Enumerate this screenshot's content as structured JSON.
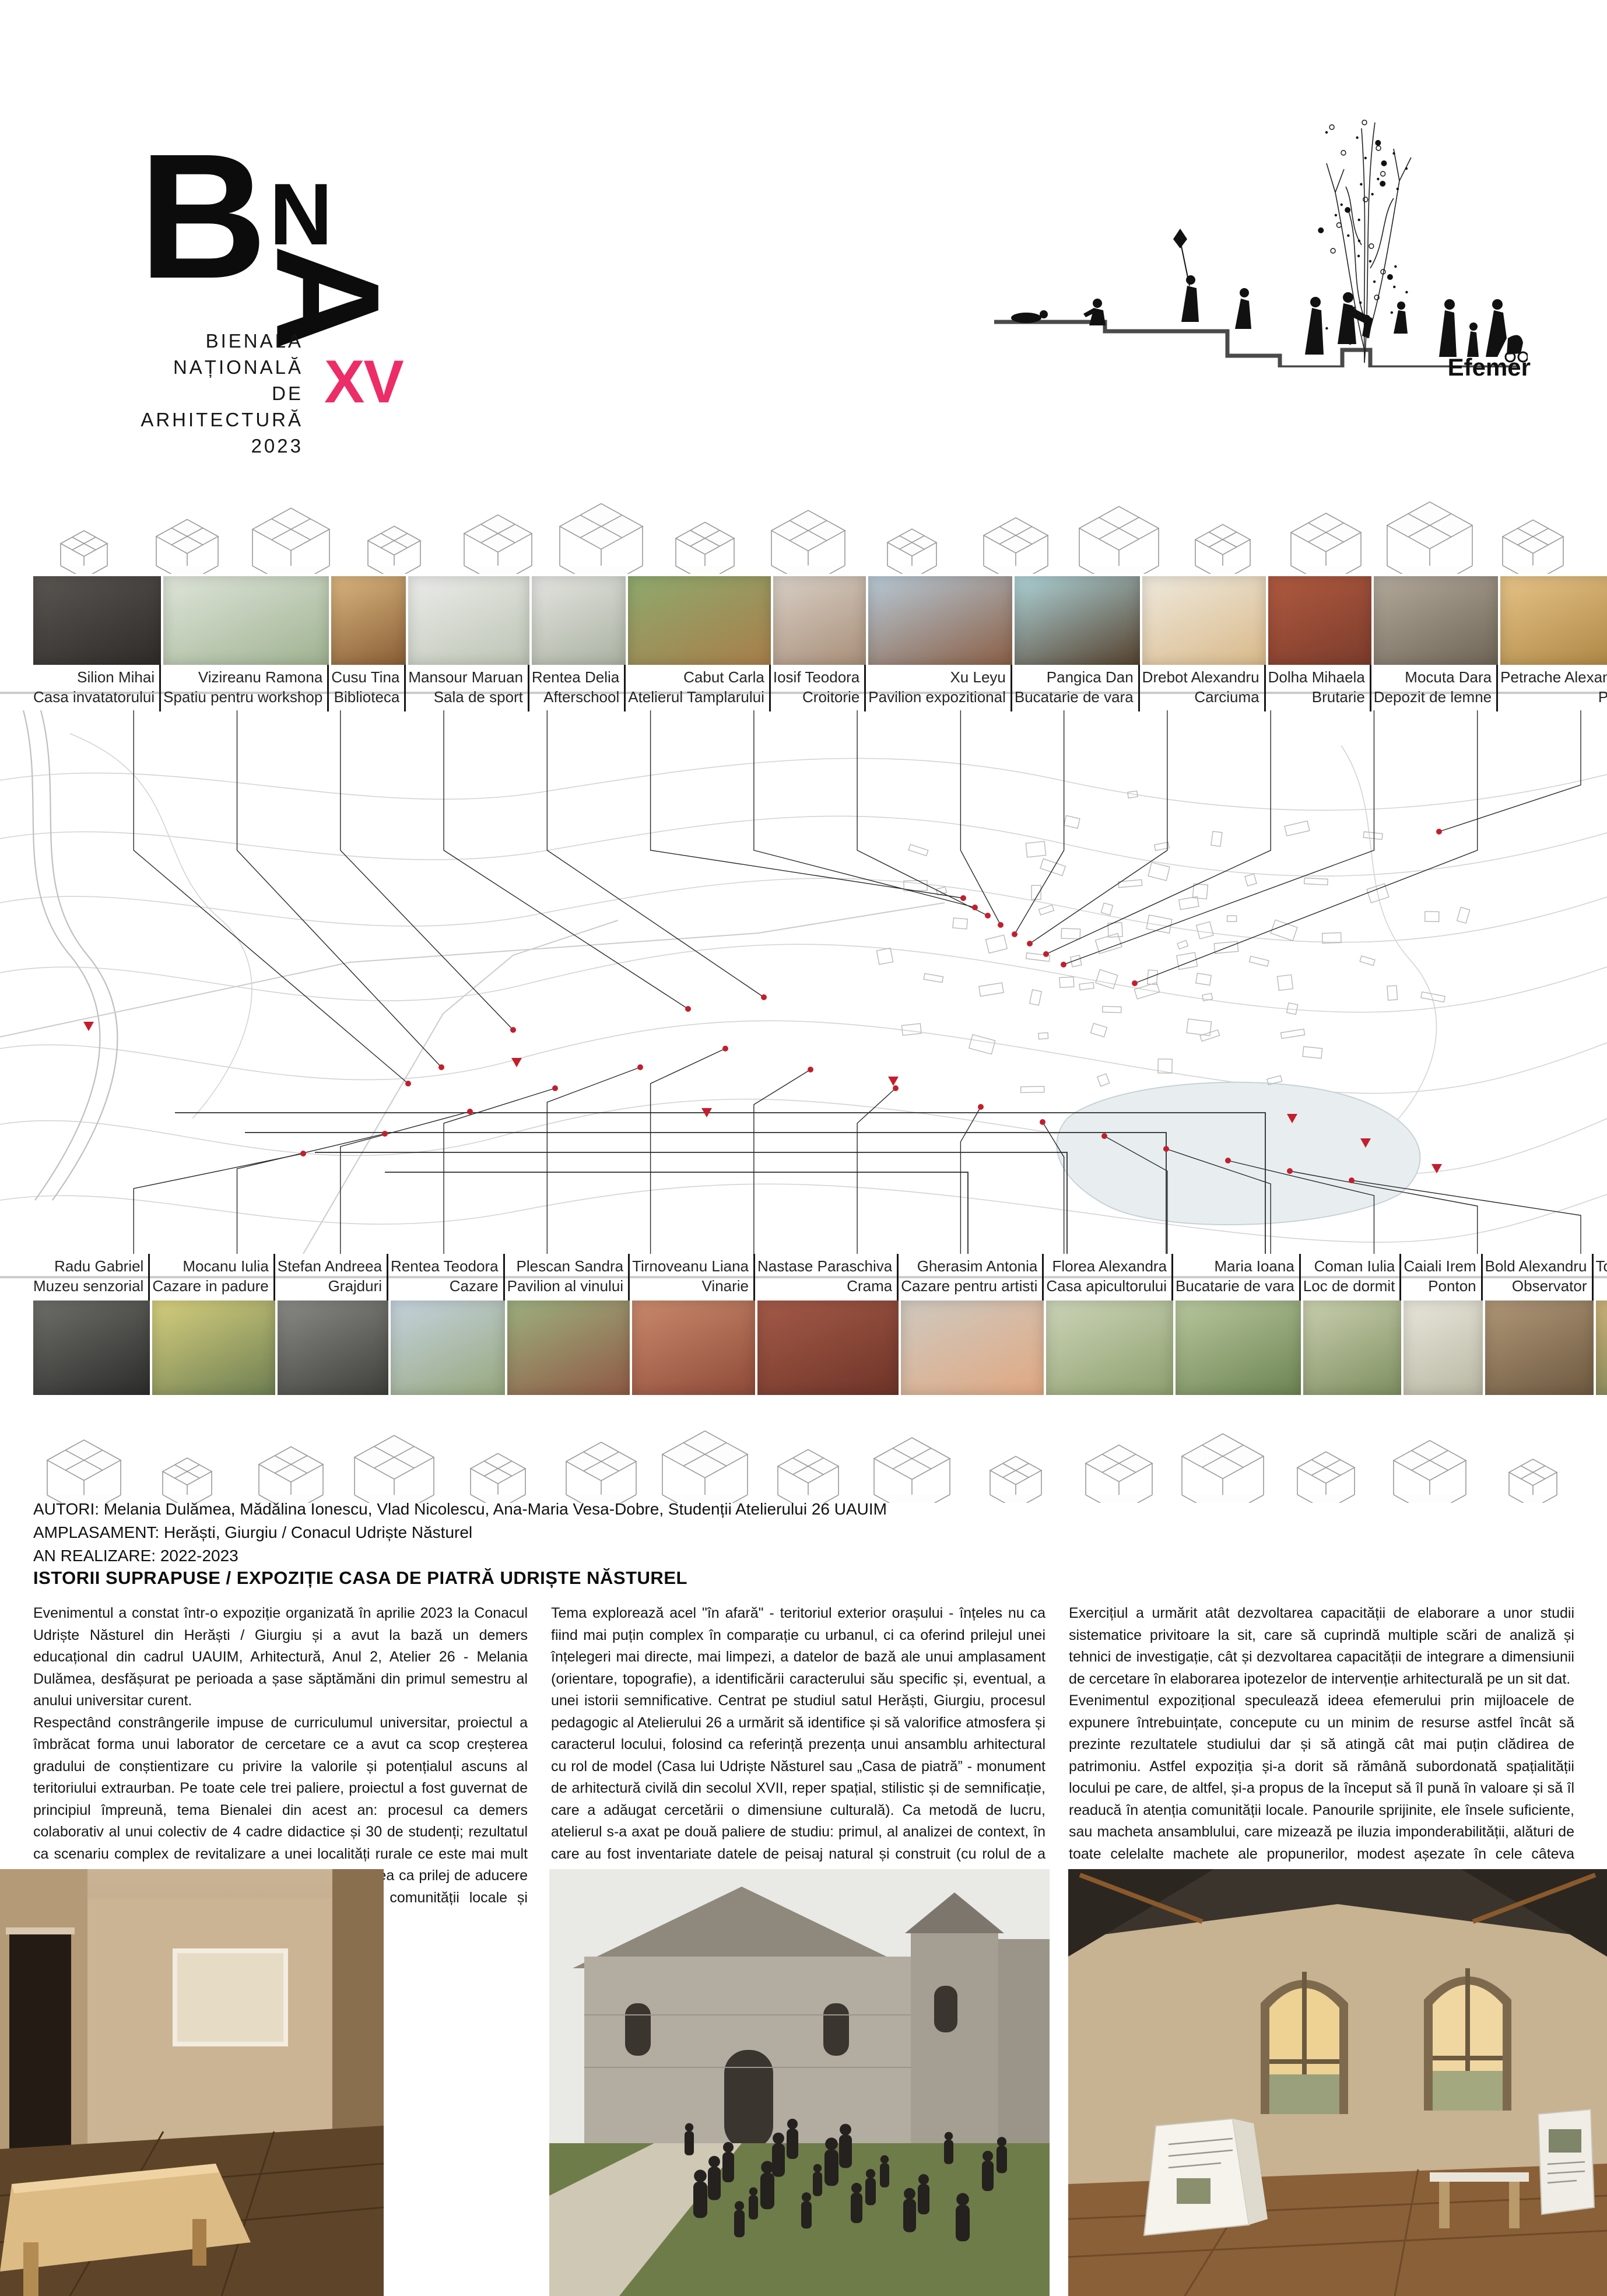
{
  "logo": {
    "b": "B",
    "n": "N",
    "a": "A",
    "lines": [
      "BIENALA",
      "NAȚIONALĂ",
      "DE",
      "ARHITECTURĂ",
      "2023"
    ],
    "edition": "XV",
    "accent_color": "#ED2D68"
  },
  "event": {
    "label": "Efemer"
  },
  "map": {
    "marker_color": "#C21F2E",
    "lake_color": "#E8EEF0"
  },
  "row1": {
    "projects": [
      {
        "name": "Silion Mihai",
        "project": "Casa invatatorului",
        "c1": "#5a5652",
        "c2": "#2e2b29"
      },
      {
        "name": "Vizireanu Ramona",
        "project": "Spatiu pentru workshop",
        "c1": "#dfe5da",
        "c2": "#9fb291"
      },
      {
        "name": "Cusu Tina",
        "project": "Biblioteca",
        "c1": "#d9b57f",
        "c2": "#8a5f36"
      },
      {
        "name": "Mansour Maruan",
        "project": "Sala de sport",
        "c1": "#ececea",
        "c2": "#bcc4b4"
      },
      {
        "name": "Rentea Delia",
        "project": "Afterschool",
        "c1": "#e4e4e0",
        "c2": "#aab2a2"
      },
      {
        "name": "Cabut Carla",
        "project": "Atelierul Tamplarului",
        "c1": "#8faa6e",
        "c2": "#a87e4a"
      },
      {
        "name": "Iosif Teodora",
        "project": "Croitorie",
        "c1": "#d8cfc6",
        "c2": "#a98f79"
      },
      {
        "name": "Xu Leyu",
        "project": "Pavilion expozitional",
        "c1": "#b7c9d6",
        "c2": "#8a5f46"
      },
      {
        "name": "Pangica Dan",
        "project": "Bucatarie de vara",
        "c1": "#aed3d8",
        "c2": "#55412e"
      },
      {
        "name": "Drebot Alexandru",
        "project": "Carciuma",
        "c1": "#efe9dd",
        "c2": "#d9b98a"
      },
      {
        "name": "Dolha Mihaela",
        "project": "Brutarie",
        "c1": "#b05a40",
        "c2": "#7c3c2c"
      },
      {
        "name": "Mocuta Dara",
        "project": "Depozit de lemne",
        "c1": "#b3aa9c",
        "c2": "#6f6557"
      },
      {
        "name": "Petrache Alexandru",
        "project": "Piata",
        "c1": "#e6c388",
        "c2": "#a9823f"
      },
      {
        "name": "Jiman Maria",
        "project": "Cazare agroturistica",
        "c1": "#dfe6d2",
        "c2": "#a9b78f"
      },
      {
        "name": "Istrate Andrei",
        "project": "Popas",
        "c1": "#8a8a88",
        "c2": "#3a3a38",
        "flag": true
      }
    ]
  },
  "row2": {
    "projects": [
      {
        "name": "Radu Gabriel",
        "project": "Muzeu senzorial",
        "c1": "#6e6e6a",
        "c2": "#2c2c2a"
      },
      {
        "name": "Mocanu Iulia",
        "project": "Cazare in padure",
        "c1": "#d6cf7e",
        "c2": "#6e7f52"
      },
      {
        "name": "Stefan Andreea",
        "project": "Grajduri",
        "c1": "#8a8a86",
        "c2": "#3f3f3c"
      },
      {
        "name": "Rentea Teodora",
        "project": "Cazare",
        "c1": "#c5d2de",
        "c2": "#97a87e"
      },
      {
        "name": "Plescan Sandra",
        "project": "Pavilion al vinului",
        "c1": "#9db07f",
        "c2": "#8f5a44"
      },
      {
        "name": "Tirnoveanu Liana",
        "project": "Vinarie",
        "c1": "#c98a6d",
        "c2": "#8f4a38"
      },
      {
        "name": "Nastase Paraschiva",
        "project": "Crama",
        "c1": "#a45a48",
        "c2": "#6e3428"
      },
      {
        "name": "Gherasim Antonia",
        "project": "Cazare pentru artisti",
        "c1": "#cfc9bf",
        "c2": "#e0a882"
      },
      {
        "name": "Florea Alexandra",
        "project": "Casa apicultorului",
        "c1": "#ccd4b8",
        "c2": "#8fa06e"
      },
      {
        "name": "Maria Ioana",
        "project": "Bucatarie de vara",
        "c1": "#b8c79e",
        "c2": "#6d8452"
      },
      {
        "name": "Coman Iulia",
        "project": "Loc de dormit",
        "c1": "#c9cfae",
        "c2": "#7f8f62"
      },
      {
        "name": "Caiali Irem",
        "project": "Ponton",
        "c1": "#e8e6da",
        "c2": "#b9b8a4"
      },
      {
        "name": "Bold Alexandru",
        "project": "Observator",
        "c1": "#b09678",
        "c2": "#6e5a40"
      },
      {
        "name": "Toader Andreea",
        "project": "Florarie",
        "c1": "#cdb27a",
        "c2": "#707c50"
      },
      {
        "name": "Mamaliga Catalina",
        "project": "Capela",
        "c1": "#e2e3e5",
        "c2": "#aaacaf"
      }
    ]
  },
  "info": {
    "autori": "AUTORI: Melania Dulămea, Mădălina Ionescu, Vlad Nicolescu, Ana-Maria Vesa-Dobre, Studenții Atelierului 26 UAUIM",
    "amplasament": "AMPLASAMENT: Herăști, Giurgiu / Conacul Udriște Năsturel",
    "an_realizare": "AN REALIZARE: 2022-2023"
  },
  "section_title": "ISTORII SUPRAPUSE / EXPOZIȚIE CASA DE PIATRĂ UDRIȘTE NĂSTUREL",
  "columns": [
    {
      "paragraphs": [
        "Evenimentul a constat într-o expoziție organizată în aprilie 2023 la Conacul Udriște Năsturel din Herăști / Giurgiu și a avut la bază un demers educațional din cadrul UAUIM, Arhitectură, Anul 2, Atelier 26 - Melania Dulămea, desfășurat pe perioada a șase săptămăni din primul semestru al anului universitar curent.",
        "Respectând constrângerile impuse de curriculumul universitar, proiectul a îmbrăcat forma unui laborator de cercetare ce a avut ca scop creșterea gradului de conștientizare cu privire la valorile  și potențialul ascuns al teritoriului extraurban. Pe toate cele trei paliere, proiectul a fost guvernat de principiul împreună, tema Bienalei din acest an: procesul ca demers colaborativ al unui colectiv de 4 cadre didactice și 30 de studenți; rezultatul ca scenariu complex de revitalizare a unei localități rurale ce este mai mult decât suma celor 30 de proiecte individuale; expunerea ca prilej de aducere împreună a profesioniștilor (studenți, profesori), a comunității locale și autorităților pentru inițierea unui dialog."
      ]
    },
    {
      "paragraphs": [
        "Tema explorează acel \"în afară\" - teritoriul exterior orașului - înțeles nu ca fiind mai puțin complex în comparație cu urbanul, ci ca oferind prilejul unei înțelegeri mai directe, mai limpezi, a datelor de bază ale unui amplasament (orientare, topografie), a identificării caracterului său specific și, eventual, a unei istorii semnificative. Centrat pe studiul satul Herăști, Giurgiu, procesul pedagogic al Atelierului 26 a urmărit să identifice și să valorifice atmosfera și caracterul locului, folosind ca referință prezența unui ansamblu arhitectural cu rol de model (Casa lui Udriște Năsturel sau „Casa de piatră” - monument de arhitectură civilă din secolul XVII, reper spațial, stilistic și de semnificație, care a adăugat cercetării o dimensiune culturală). Ca metodă de lucru, atelierul s-a axat pe două paliere de studiu: primul, al analizei de context, în care au fost inventariate datele de peisaj natural și construit (cu rolul de a suscita imaginația și a de a adăuga complexitate proiectelor), accesibilitatea (fluxuri, parcursuri, promenade, trasee), limite și margini (cu rolul fundamental de a marca și defini zone de țesut: au fost identificate variate texturi și pliuri de construit/neconstruit, vegetal/mineral, pământ/apă, profan/sacru), și al doilea, al imaginării unor inserții coerente spațial-arhitectural și contextual, în care au fost interogate funcțiuni contemporane, capabile să contribuie la o revalorificare reală a patrimoniului rural existent."
      ]
    },
    {
      "paragraphs": [
        "Exercițiul a urmărit atât dezvoltarea capacității de elaborare a unor studii sistematice privitoare la sit, care să cuprindă multiple scări de analiză și tehnici de investigație, cât și dezvoltarea capacității de integrare a dimensiunii de cercetare în elaborarea ipotezelor de intervenție arhitecturală pe un sit dat.",
        "Evenimentul expozițional speculează ideea efemerului prin mijloacele de expunere întrebuințate, concepute cu un minim de resurse astfel încât să prezinte rezultatele studiului dar și să atingă cât mai puțin clădirea de patrimoniu. Astfel expoziția și-a dorit să rămână subordonată spațialității locului pe care, de altfel, și-a propus de la început să îl pună în valoare și să îl readucă în atenția comunității locale. Panourile sprijinite, ele însele suficiente, sau macheta ansamblului, care mizează pe iluzia imponderabilității, alături de toate celelalte machete ale propunerilor, modest așezate în cele câteva încăperi de o spațialitate cu totul specială, nu reprezintă decât pretextul redescoperirii acestui loc, al expunerii câtorva idei care ar putea să valorifice potențialul acestuia sau simplul prilej al aducerii împreună, în care memoria culturală a unui loc aduce posibile soluții unor nevoi reale ale întregii comunități pe care ajunge să o reprezinte."
      ]
    }
  ]
}
